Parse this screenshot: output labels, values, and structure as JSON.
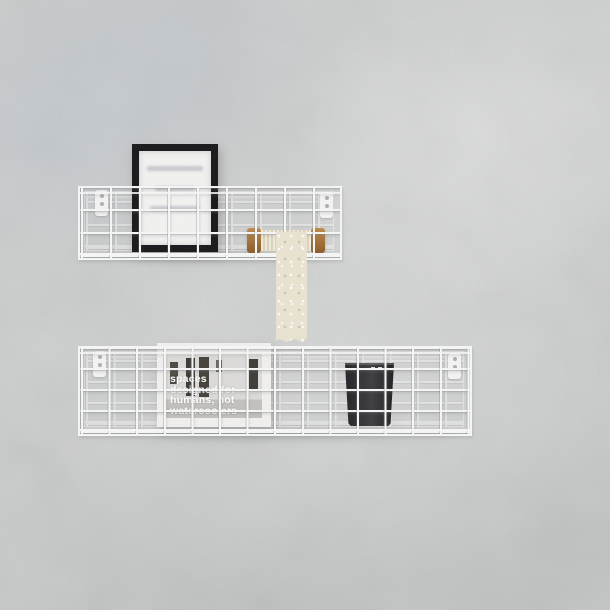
{
  "wall": {
    "base_color": "#cbcdcc",
    "patch_tint": "#c4cad3"
  },
  "top_shelf": {
    "wire_color": "#f6f7f6",
    "black_frame": {
      "frame_color": "#17171a",
      "mat_color": "#f2f2f1"
    },
    "spool": {
      "wood_color": "#a9713c",
      "lace_color": "#eae3d1"
    }
  },
  "bottom_shelf": {
    "wire_color": "#f6f7f6",
    "poster": {
      "frame_color": "#f1f0ee",
      "text_color": "#ffffff",
      "text_lines": [
        "spaces",
        "designed for",
        "humans, not",
        "watercoolers"
      ]
    },
    "cup": {
      "color": "#2b2b2e"
    }
  }
}
